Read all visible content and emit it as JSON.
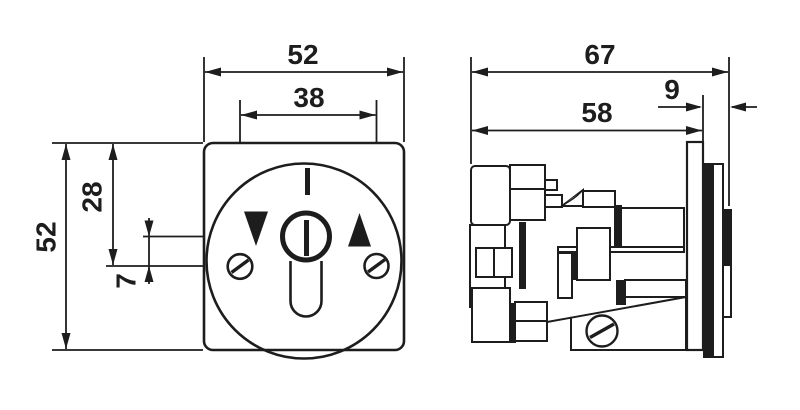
{
  "colors": {
    "line": "#1d1d1d",
    "background": "#ffffff"
  },
  "front_view": {
    "dimensions": {
      "overall_width": "52",
      "screw_spacing": "38",
      "top_edge_to_screw_axis": "28",
      "key_axis_to_screw_axis": "7",
      "overall_height": "52"
    }
  },
  "side_view": {
    "dimensions": {
      "overall_depth": "67",
      "body_depth": "58",
      "front_protrusion": "9"
    }
  }
}
